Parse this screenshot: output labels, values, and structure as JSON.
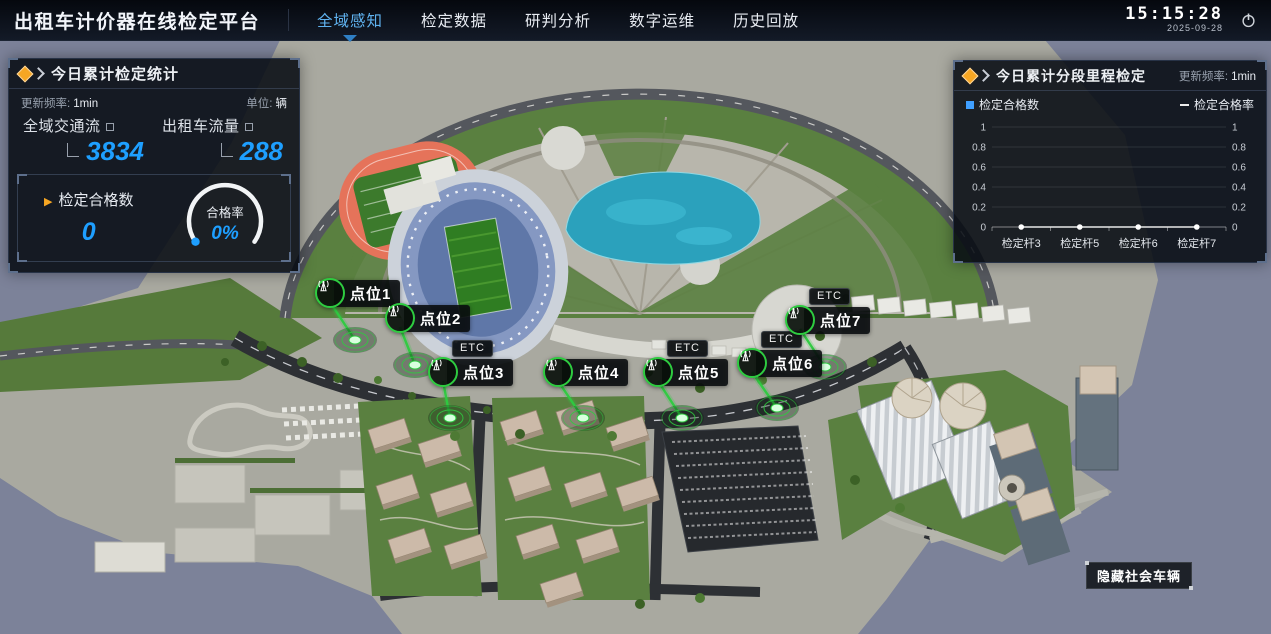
{
  "colors": {
    "accent_blue": "#1e9fff",
    "active_tab": "#5fb2ef",
    "marker_green": "#2ecc40",
    "title_orange": "#f6a623"
  },
  "header": {
    "title": "出租车计价器在线检定平台",
    "nav": [
      {
        "label": "全域感知",
        "active": true
      },
      {
        "label": "检定数据",
        "active": false
      },
      {
        "label": "研判分析",
        "active": false
      },
      {
        "label": "数字运维",
        "active": false
      },
      {
        "label": "历史回放",
        "active": false
      }
    ],
    "time": "15:15:28",
    "date": "2025-09-28",
    "power_icon": "power-icon"
  },
  "left_panel": {
    "title": "今日累计检定统计",
    "update_prefix": "更新频率:",
    "update_value": "1min",
    "unit_prefix": "单位:",
    "unit_value": "辆",
    "stats": [
      {
        "label": "全域交通流",
        "value": "3834"
      },
      {
        "label": "出租车流量",
        "value": "288"
      }
    ],
    "pass_count_label": "检定合格数",
    "pass_count_value": "0",
    "gauge": {
      "label": "合格率",
      "value": "0%",
      "percent": 0
    }
  },
  "right_panel": {
    "title": "今日累计分段里程检定",
    "update_prefix": "更新频率:",
    "update_value": "1min",
    "legend": [
      {
        "label": "检定合格数",
        "marker": "square",
        "color": "#3f9fff"
      },
      {
        "label": "检定合格率",
        "marker": "dash",
        "color": "#ececec"
      }
    ]
  },
  "chart_data": {
    "type": "line",
    "title": "今日累计分段里程检定",
    "categories": [
      "检定杆3",
      "检定杆5",
      "检定杆6",
      "检定杆7"
    ],
    "series": [
      {
        "name": "检定合格数",
        "type": "bar",
        "values": [
          0,
          0,
          0,
          0
        ]
      },
      {
        "name": "检定合格率",
        "type": "line",
        "values": [
          0,
          0,
          0,
          0
        ]
      }
    ],
    "ylim": [
      0,
      1
    ],
    "yticks": [
      0,
      0.2,
      0.4,
      0.6,
      0.8,
      1
    ],
    "grid": true,
    "legend_position": "top",
    "xlabel": "",
    "ylabel": ""
  },
  "map": {
    "markers": [
      {
        "label": "点位1",
        "etc": ""
      },
      {
        "label": "点位2",
        "etc": ""
      },
      {
        "label": "点位3",
        "etc": "ETC"
      },
      {
        "label": "点位4",
        "etc": ""
      },
      {
        "label": "点位5",
        "etc": "ETC"
      },
      {
        "label": "点位6",
        "etc": "ETC"
      },
      {
        "label": "点位7",
        "etc": "ETC"
      }
    ],
    "etc_badge": "ETC",
    "hide_vehicles_button": "隐藏社会车辆"
  }
}
